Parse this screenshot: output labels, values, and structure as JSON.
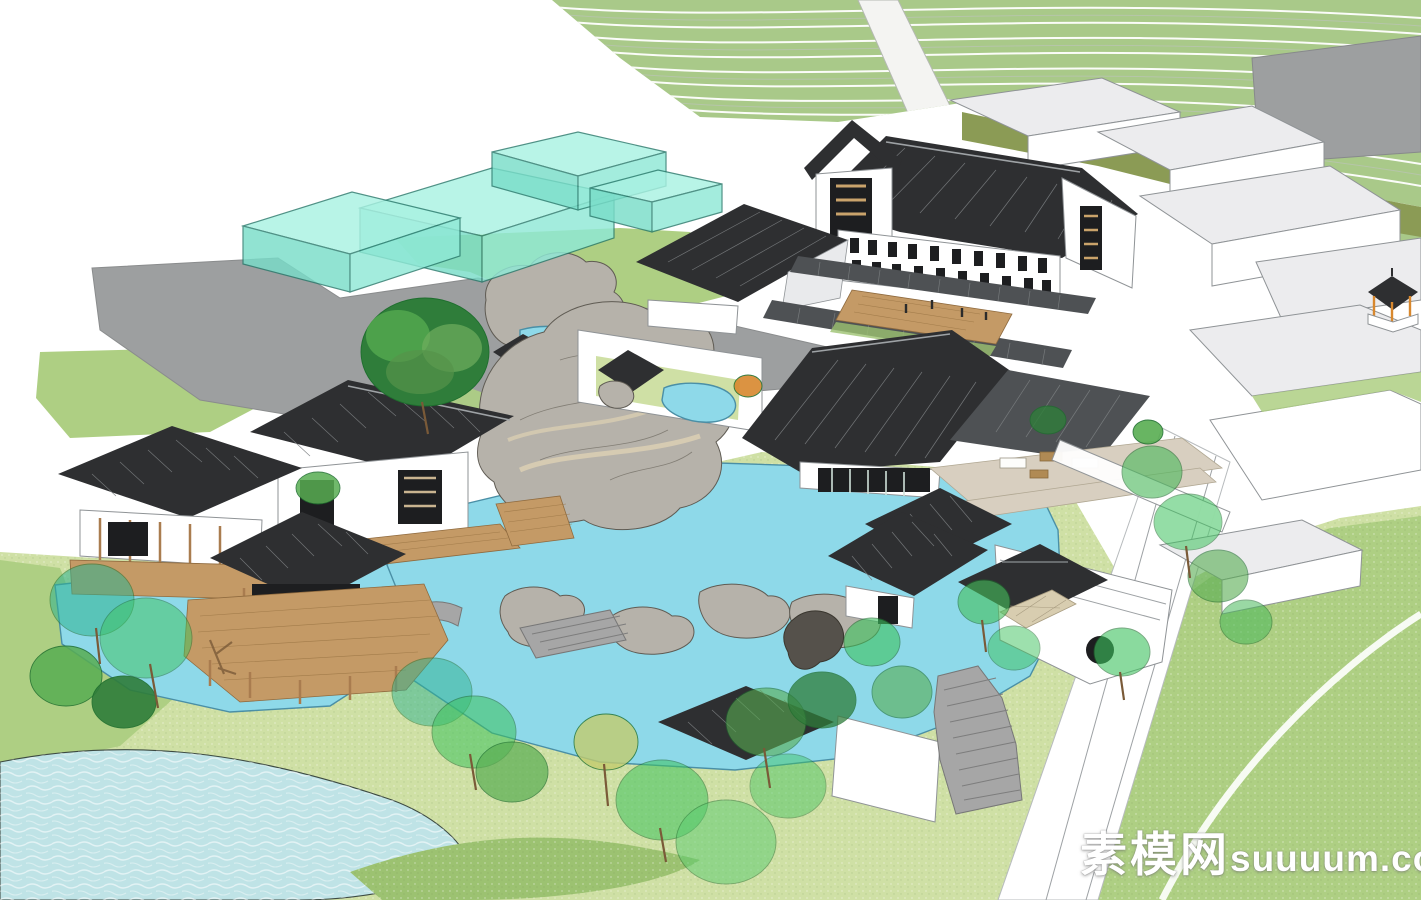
{
  "watermark": {
    "site_name": "素模网",
    "domain": "suuuum.com"
  },
  "colors": {
    "terrace_green": "#a9c989",
    "terrace_line": "#ffffff",
    "paved_gray": "#9d9fa0",
    "olive_green": "#8b9b55",
    "glass_teal_top": "#a9f2e2",
    "glass_teal_front": "#79ddc9",
    "glass_teal_side": "#8fe9d6",
    "glass_edge": "#2a7a6c",
    "roof_dark": "#2e2f31",
    "roof_mid": "#4e5154",
    "roof_pale": "#ececee",
    "roof_seam": "#7a7d80",
    "wall_white": "#ffffff",
    "wall_shade": "#e9eaec",
    "edge_gray": "#8f9396",
    "window_dark": "#1d1e20",
    "wood_brown": "#a97c4f",
    "deck_tan": "#c49a66",
    "terrace_beige": "#d8cfc0",
    "stone_gray": "#a6a6a6",
    "rock_gray": "#b6b2aa",
    "rock_shadow": "#7c786f",
    "rock_edge": "#5f5b53",
    "pond_blue": "#8ed9e9",
    "stream_blue": "#bfe3e6",
    "water_edge": "#4a8fa6",
    "lawn_green": "#aecf83",
    "grass_light": "#cfe0a5",
    "grass_mid": "#9cc271",
    "tree_bright": "#3ec35e",
    "tree_mid": "#58ad52",
    "tree_dark": "#2f7d3a",
    "tree_teal": "#2fb391",
    "tree_yellow": "#c3cc6e",
    "trunk_brown": "#7a5a38",
    "accent_orange": "#d8882e",
    "watermark_white": "#ffffff"
  }
}
